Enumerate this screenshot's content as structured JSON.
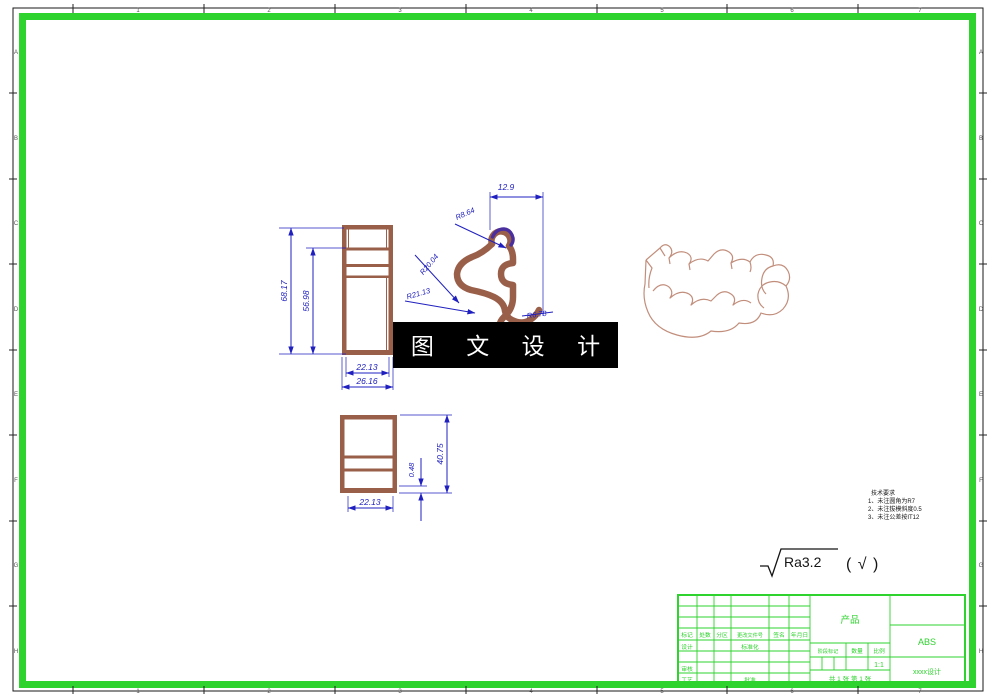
{
  "colors": {
    "frame_green": "#2ed32e",
    "entity_brown": "#9a5f49",
    "iso_brown": "#c28e7c",
    "dimension_blue": "#2020c0",
    "highlight_purple": "#4a2f9f"
  },
  "zones": {
    "numbers": [
      "1",
      "2",
      "3",
      "4",
      "5",
      "6",
      "7"
    ],
    "letters": [
      "A",
      "B",
      "C",
      "D",
      "E",
      "F",
      "G",
      "H"
    ]
  },
  "watermark": {
    "text": "图 文 设 计"
  },
  "dims": {
    "side": {
      "h_outer": "68.17",
      "h_inner": "56.98",
      "w_inner": "22.13",
      "w_outer": "26.16"
    },
    "profile": {
      "top_width": "12.9",
      "r_small": "R8.64",
      "r_mid": "R20.04",
      "r_large": "R21.13",
      "r_lower": "R6.78"
    },
    "bottom": {
      "height": "40.75",
      "rib": "0.48",
      "width": "22.13"
    }
  },
  "notes": {
    "title": "技术要求",
    "items": [
      "1、未注圆角为R7",
      "2、未注拔模斜度0.5",
      "3、未注公差按IT12"
    ]
  },
  "roughness": {
    "value": "Ra3.2",
    "paren": "( √ )"
  },
  "title_block": {
    "col_headers": [
      "标记",
      "处数",
      "分区",
      "更改文件号",
      "签名",
      "年月日"
    ],
    "row_design": "设计",
    "row_standard": "标准化",
    "row_audit": "审核",
    "row_craft": "工艺",
    "row_approve": "批准",
    "stage_label": "阶段标记",
    "qty_label": "数量",
    "scale_label": "比例",
    "scale_value": "1:1",
    "sheet_info": "共 1 张  第 1 张",
    "product": "产品",
    "material": "ABS",
    "company": "xxxx设计"
  }
}
